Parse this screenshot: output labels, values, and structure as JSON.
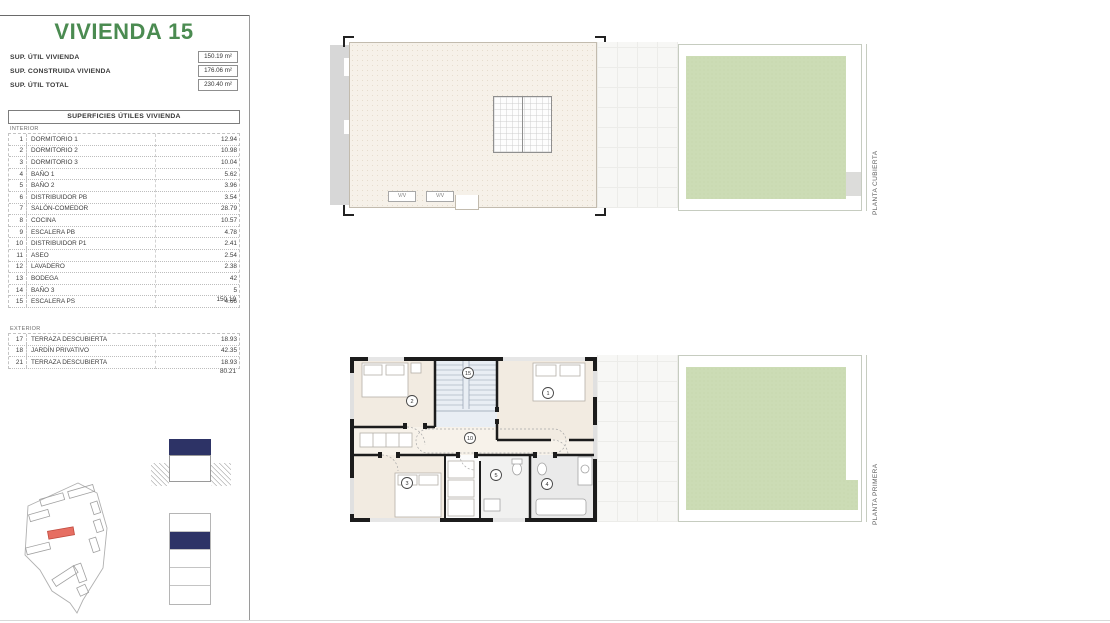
{
  "colors": {
    "brand_green": "#4b8b51",
    "legend_navy": "#2d3366",
    "garden_green": "#ccdcb5",
    "highlight_red": "#e66e62"
  },
  "sidebar": {
    "title": "VIVIENDA 15",
    "summary": [
      {
        "label": "SUP. ÚTIL VIVIENDA",
        "value": "150.19 m²"
      },
      {
        "label": "SUP. CONSTRUIDA VIVIENDA",
        "value": "176.06 m²"
      },
      {
        "label": "SUP. ÚTIL TOTAL",
        "value": "230.40 m²"
      }
    ],
    "table_header": "SUPERFICIES ÚTILES VIVIENDA",
    "interior_label": "INTERIOR",
    "interior_rows": [
      {
        "num": "1",
        "name": "DORMITORIO 1",
        "value": "12.94"
      },
      {
        "num": "2",
        "name": "DORMITORIO 2",
        "value": "10.98"
      },
      {
        "num": "3",
        "name": "DORMITORIO 3",
        "value": "10.04"
      },
      {
        "num": "4",
        "name": "BAÑO 1",
        "value": "5.62"
      },
      {
        "num": "5",
        "name": "BAÑO 2",
        "value": "3.96"
      },
      {
        "num": "6",
        "name": "DISTRIBUIDOR PB",
        "value": "3.54"
      },
      {
        "num": "7",
        "name": "SALÓN-COMEDOR",
        "value": "28.79"
      },
      {
        "num": "8",
        "name": "COCINA",
        "value": "10.57"
      },
      {
        "num": "9",
        "name": "ESCALERA PB",
        "value": "4.78"
      },
      {
        "num": "10",
        "name": "DISTRIBUIDOR P1",
        "value": "2.41"
      },
      {
        "num": "11",
        "name": "ASEO",
        "value": "2.54"
      },
      {
        "num": "12",
        "name": "LAVADERO",
        "value": "2.38"
      },
      {
        "num": "13",
        "name": "BODEGA",
        "value": "42"
      },
      {
        "num": "14",
        "name": "BAÑO 3",
        "value": "5"
      },
      {
        "num": "15",
        "name": "ESCALERA PS",
        "value": "4.66"
      }
    ],
    "interior_total": "150.19",
    "exterior_label": "EXTERIOR",
    "exterior_rows": [
      {
        "num": "17",
        "name": "TERRAZA DESCUBIERTA",
        "value": "18.93"
      },
      {
        "num": "18",
        "name": "JARDÍN PRIVATIVO",
        "value": "42.35"
      },
      {
        "num": "21",
        "name": "TERRAZA DESCUBIERTA",
        "value": "18.93"
      }
    ],
    "exterior_total": "80.21"
  },
  "plans": {
    "roof": {
      "side_label": "PLANTA CUBIERTA",
      "vent_labels": [
        "V/V",
        "V/V"
      ]
    },
    "first": {
      "side_label": "PLANTA PRIMERA",
      "markers": [
        "2",
        "15",
        "1",
        "10",
        "3",
        "5",
        "4"
      ]
    }
  }
}
